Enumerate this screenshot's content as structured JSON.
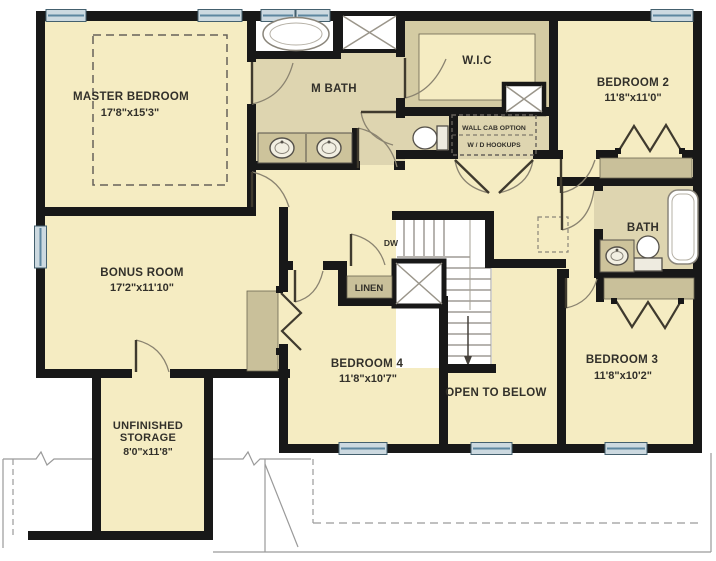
{
  "plan": {
    "title": "Second floor plan",
    "rooms": {
      "master": {
        "name": "MASTER BEDROOM",
        "dims": "17'8\"x15'3\""
      },
      "mbath": {
        "name": "M BATH"
      },
      "wic": {
        "name": "W.I.C"
      },
      "bedroom2": {
        "name": "BEDROOM 2",
        "dims": "11'8\"x11'0\""
      },
      "bath": {
        "name": "BATH"
      },
      "bedroom3": {
        "name": "BEDROOM 3",
        "dims": "11'8\"x10'2\""
      },
      "bedroom4": {
        "name": "BEDROOM 4",
        "dims": "11'8\"x10'7\""
      },
      "bonus": {
        "name": "BONUS ROOM",
        "dims": "17'2\"x11'10\""
      },
      "storage": {
        "name_line1": "UNFINISHED",
        "name_line2": "STORAGE",
        "dims": "8'0\"x11'8\""
      },
      "open_below": {
        "name": "OPEN TO BELOW"
      },
      "linen": {
        "name": "LINEN"
      }
    },
    "annotations": {
      "dw": "DW",
      "wall_cab_option": "WALL CAB OPTION",
      "wd_hookups": "W / D HOOKUPS"
    },
    "colors": {
      "room_fill": "#f5ecc2",
      "bath_fill": "#ded5b0",
      "closet_fill": "#c9c09a",
      "wic_surround": "#d4cba3",
      "wall": "#181818",
      "window_fill": "#ccd9e0",
      "window_line": "#5d87a0",
      "arc": "#8a8370",
      "leaf": "#3f3a2e"
    }
  }
}
